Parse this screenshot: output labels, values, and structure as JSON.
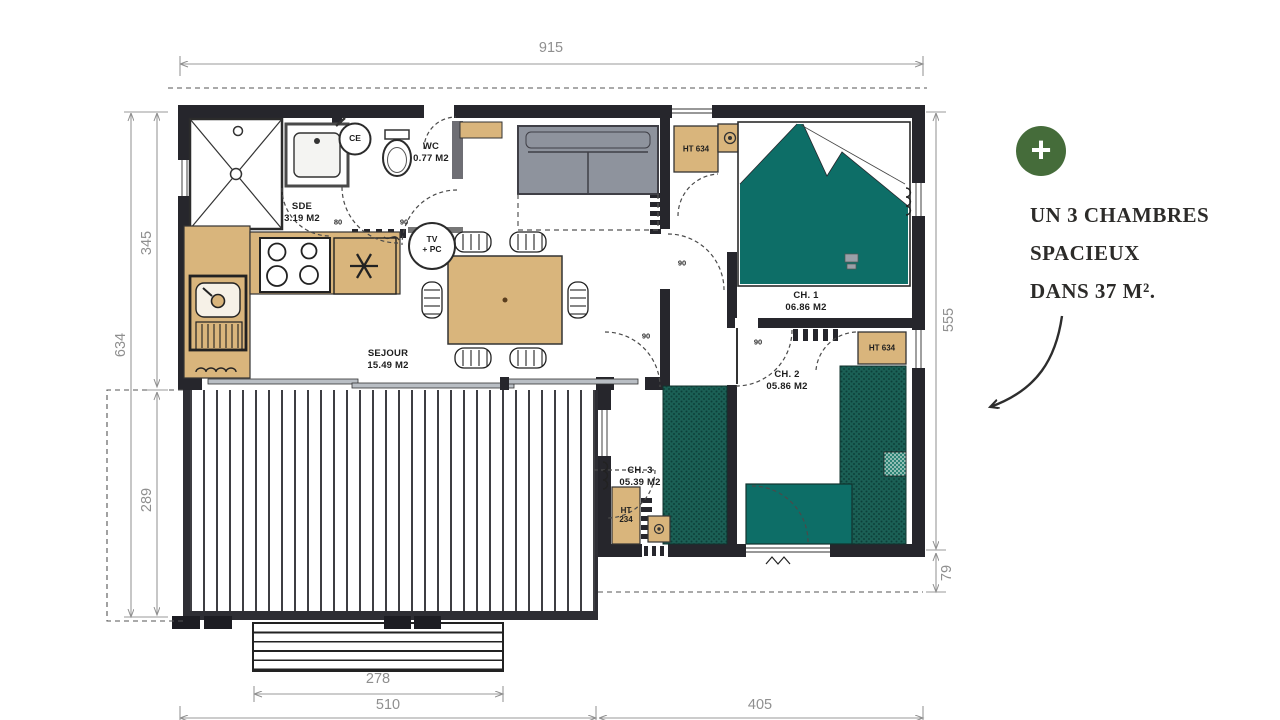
{
  "plan": {
    "dimensions": {
      "width_total": "915",
      "left_upper": "345",
      "left_total": "634",
      "left_lower": "289",
      "right_main": "555",
      "right_lower": "79",
      "steps_width": "278",
      "bottom_left": "510",
      "bottom_right": "405"
    },
    "rooms": {
      "sde": {
        "name": "SDE",
        "area": "3.19 M2"
      },
      "wc": {
        "name": "WC",
        "area": "0.77 M2"
      },
      "sejour": {
        "name": "SEJOUR",
        "area": "15.49 M2"
      },
      "ch1": {
        "name": "CH. 1",
        "area": "06.86 M2"
      },
      "ch2": {
        "name": "CH. 2",
        "area": "05.86 M2"
      },
      "ch3": {
        "name": "CH. 3",
        "area": "05.39 M2"
      }
    },
    "fixtures": {
      "water_heater": "CE",
      "tv_line1": "TV",
      "tv_line2": "+ PC",
      "cabinet_tall": "HT 634",
      "cabinet_small_line1": "HT",
      "cabinet_small_line2": "234"
    },
    "door_widths": {
      "sde": "80",
      "wc": "90",
      "hall": "90",
      "ch3": "90",
      "ch2": "90"
    }
  },
  "annotation": {
    "plus": "+",
    "line1": "UN 3 CHAMBRES",
    "line2": "SPACIEUX",
    "line3": "DANS 37 M²."
  },
  "colors": {
    "wall": "#26262c",
    "wood": "#d9b57c",
    "teal": "#0d6e67",
    "teal_dark": "#1b6055",
    "sofa_gray": "#8e939d",
    "accent_green": "#456c3a",
    "dim_gray": "#8f8f8f"
  }
}
